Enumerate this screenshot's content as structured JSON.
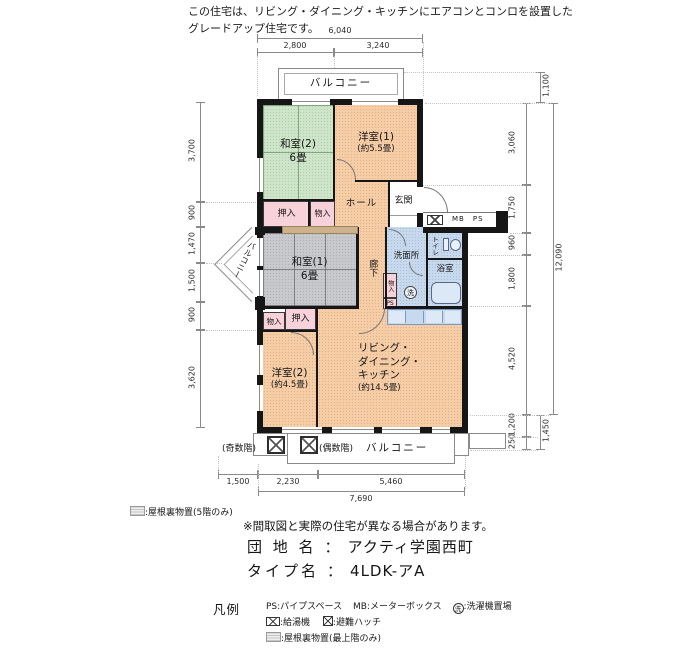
{
  "header": {
    "line1": "この住宅は、リビング・ダイニング・キッチンにエアコンとコンロを設置した",
    "line2": "グレードアップ住宅です。"
  },
  "plan": {
    "balcony_top": "バルコニー",
    "balcony_left": "バルコニー",
    "rooms": {
      "washitsu2_name": "和室(2)",
      "washitsu2_size": "6畳",
      "yoshitsu1_name": "洋室(1)",
      "yoshitsu1_size": "(約5.5畳)",
      "washitsu1_name": "和室(1)",
      "washitsu1_size": "6畳",
      "yoshitsu2_name": "洋室(2)",
      "yoshitsu2_size": "(約4.5畳)",
      "ldk_line1": "リビング・",
      "ldk_line2": "ダイニング・",
      "ldk_line3": "キッチン",
      "ldk_size": "(約14.5畳)",
      "hall": "ホール",
      "genkan": "玄関",
      "rouka": "廊下",
      "senmenjo": "洗面所",
      "toilet": "トイレ",
      "bath": "浴室",
      "oshiire_upper": "押入",
      "monoire_upper": "物入",
      "oshiire_lower": "押入",
      "monoire_lower": "物入",
      "monoire_small": "物入",
      "ps_small": "PS",
      "laundry_mark": "洗",
      "mb_ps": "MB　PS"
    },
    "balcony_bottom": {
      "odd": "(奇数階)",
      "even": "(偶数階)",
      "label": "バルコニー"
    }
  },
  "dims": {
    "top_total": "6,040",
    "top": [
      "2,800",
      "3,240"
    ],
    "left": [
      "3,700",
      "900",
      "1,470",
      "1,500",
      "900",
      "3,620"
    ],
    "right_top": "1,100",
    "right": [
      "3,060",
      "1,750",
      "960",
      "1,800",
      "4,520",
      "1,200",
      "250"
    ],
    "right_total": "12,090",
    "right_bottom": "1,450",
    "bottom": [
      "1,500",
      "2,230",
      "5,460"
    ],
    "bottom_total": "7,690"
  },
  "notes": {
    "attic5": ":屋根裏物置(5階のみ)",
    "disclaimer": "※間取図と実際の住宅が異なる場合があります。",
    "danchi_label": "団 地 名",
    "colon": "：",
    "danchi_value": "アクティ学園西町",
    "type_label": "タイプ名",
    "type_value": "4LDK-アA"
  },
  "legend": {
    "title": "凡例",
    "ps": "PS:パイプスペース",
    "mb": "MB:メーターボックス",
    "laundry_mark": "洗",
    "laundry": ":洗濯機置場",
    "heater": ":給湯機",
    "hatch": ":避難ハッチ",
    "attic": ":屋根裏物置(最上階のみ)"
  }
}
